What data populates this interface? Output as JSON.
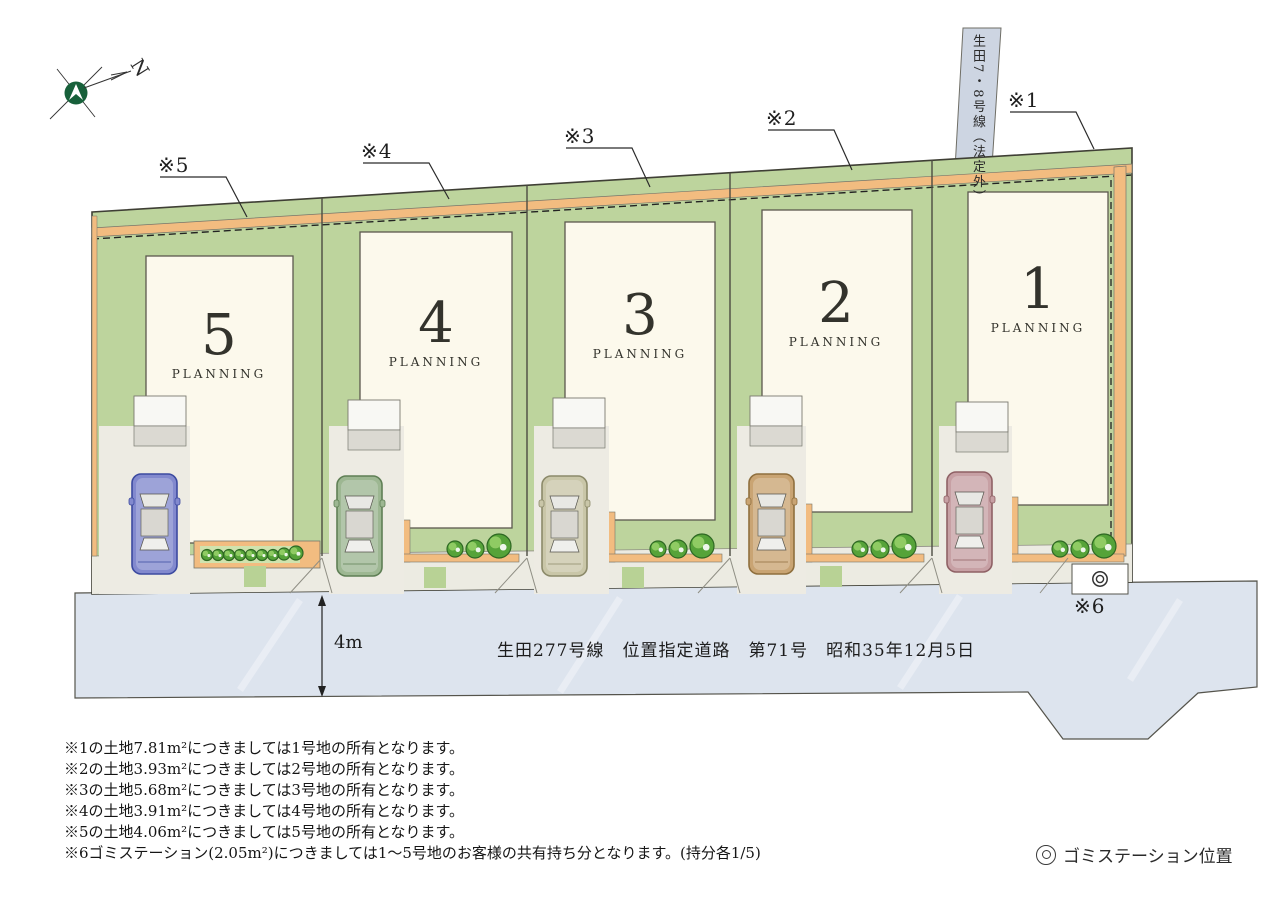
{
  "compass": {
    "north_label": "N"
  },
  "roads": {
    "north_road_label": "生田7・8号線（法定外）",
    "front_road_name": "生田277号線　位置指定道路　第71号　昭和35年12月5日",
    "front_road_width": "4m"
  },
  "markers": {
    "m1": "※1",
    "m2": "※2",
    "m3": "※3",
    "m4": "※4",
    "m5": "※5",
    "m6": "※6"
  },
  "lots": [
    {
      "number": "1",
      "planning_label": "PLANNING",
      "car_color": "#c7a0a4",
      "car_trim_color": "#8f6165"
    },
    {
      "number": "2",
      "planning_label": "PLANNING",
      "car_color": "#c9a473",
      "car_trim_color": "#8f6f3e"
    },
    {
      "number": "3",
      "planning_label": "PLANNING",
      "car_color": "#c9c6a8",
      "car_trim_color": "#8c8a6a"
    },
    {
      "number": "4",
      "planning_label": "PLANNING",
      "car_color": "#9db792",
      "car_trim_color": "#5f7f55"
    },
    {
      "number": "5",
      "planning_label": "PLANNING",
      "car_color": "#8289ce",
      "car_trim_color": "#3c4aa0"
    }
  ],
  "notes": [
    "※1の土地7.81m²につきましては1号地の所有となります。",
    "※2の土地3.93m²につきましては2号地の所有となります。",
    "※3の土地5.68m²につきましては3号地の所有となります。",
    "※4の土地3.91m²につきましては4号地の所有となります。",
    "※5の土地4.06m²につきましては5号地の所有となります。",
    "※6ゴミステーション(2.05m²)につきましては1～5号地のお客様の共有持ち分となります。(持分各1/5)"
  ],
  "legend": {
    "symbol": "◎",
    "garbage_station_label": "ゴミステーション位置"
  },
  "colors": {
    "lot_green": "#bdd49d",
    "setback_orange": "#f2bc80",
    "front_road_gray_blue": "#dde4ee",
    "north_road_gray_blue": "#cdd5e2",
    "building_cream": "#fcf9ec",
    "compass_green": "#17603a"
  }
}
